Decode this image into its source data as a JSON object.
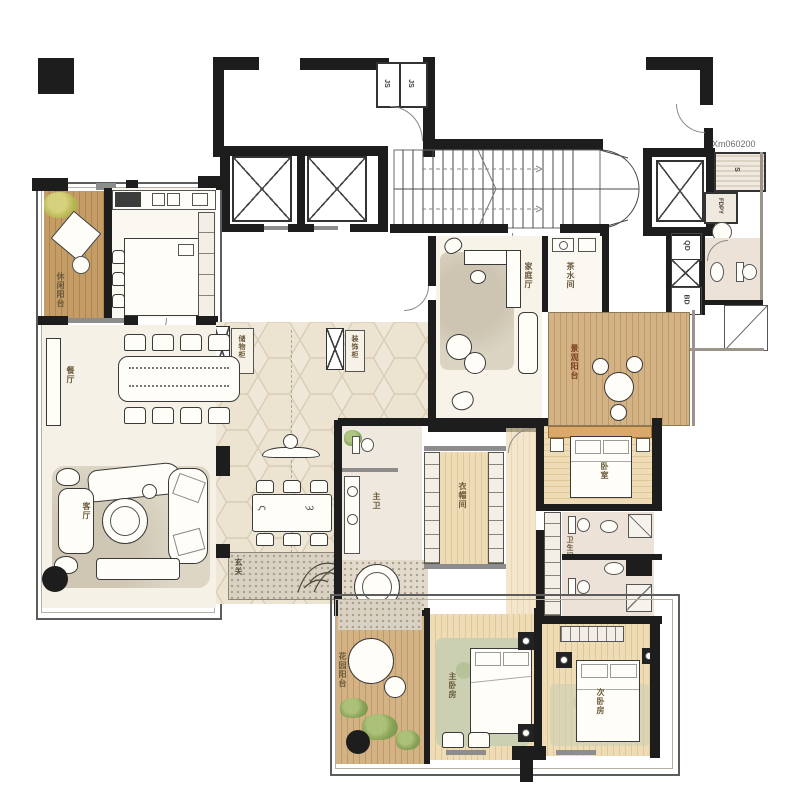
{
  "plan": {
    "code": "Xm060200",
    "rooms": {
      "leisure_balcony": "休闲阳台",
      "kitchen": "厨房",
      "dining": "餐厅",
      "living": "客厅",
      "foyer": "玄关",
      "hall_cab_left": "储物柜",
      "hall_cab_right": "装饰柜",
      "family": "家庭厅",
      "pantry": "茶水间",
      "view_balcony": "景观阳台",
      "bedroom1": "卧室",
      "closet": "衣帽间",
      "master_bath": "主卫",
      "bath1": "卫生间",
      "master_bedroom": "主卧房",
      "bedroom2": "次卧房",
      "garden_balcony": "花园阳台"
    },
    "shafts": {
      "js": "JS",
      "s": "S",
      "fdpy": "FDPY",
      "qd": "QD",
      "bd": "BD"
    }
  }
}
